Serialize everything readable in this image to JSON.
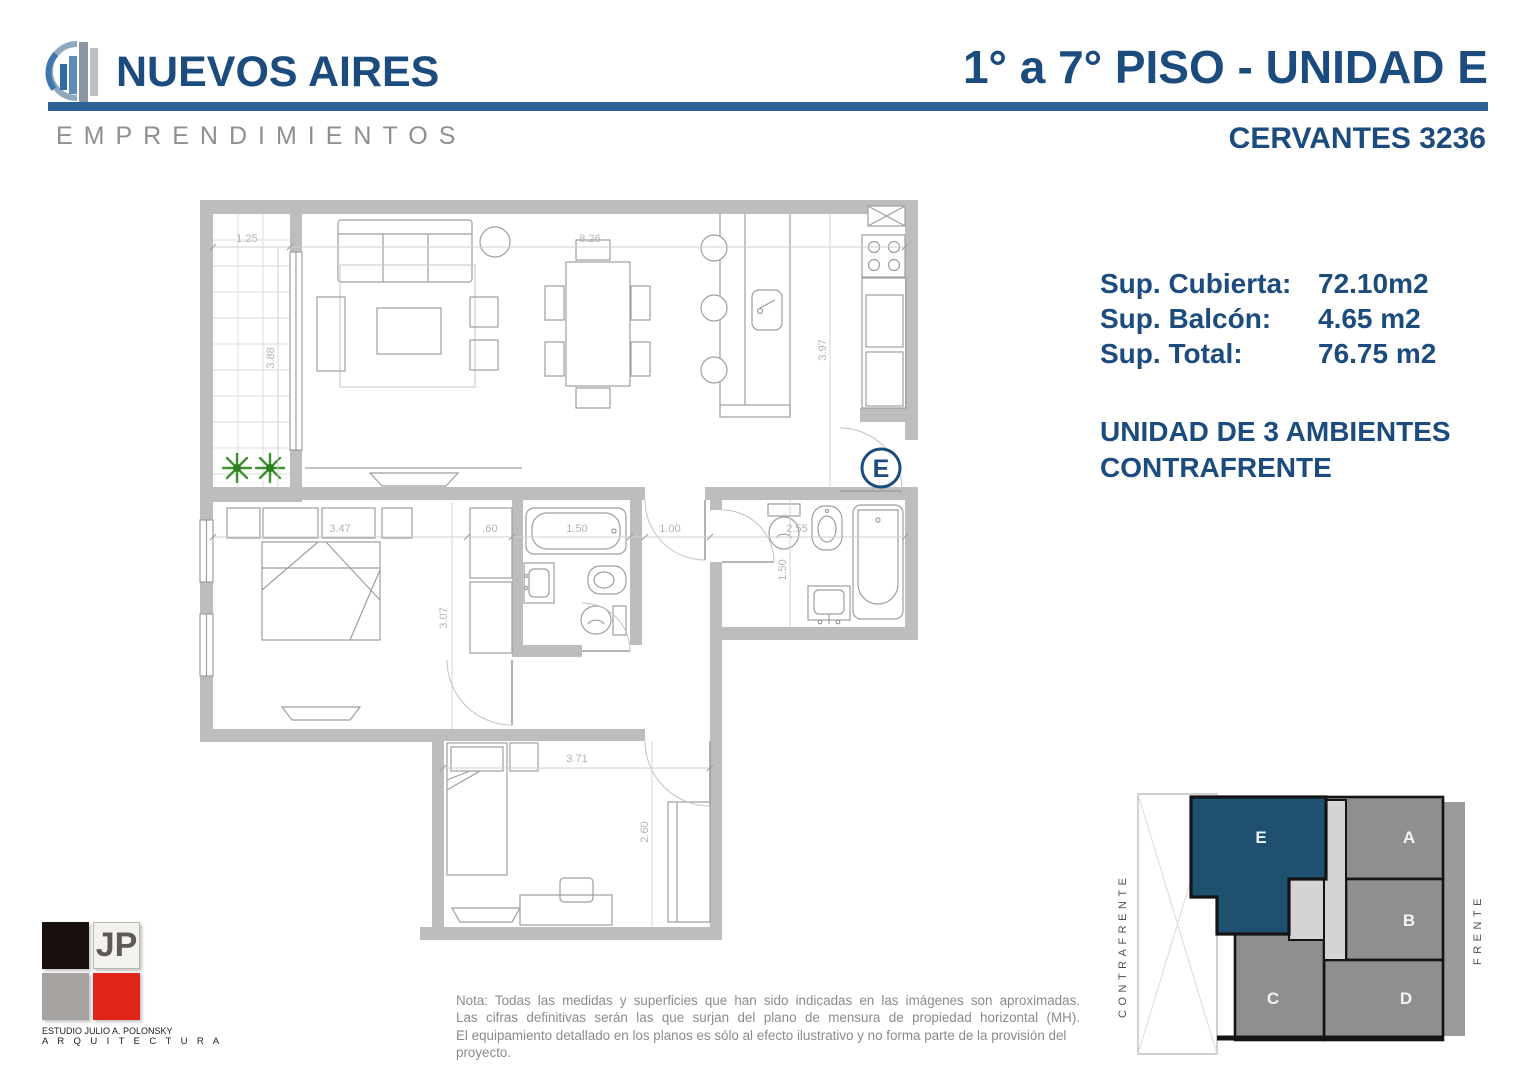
{
  "header": {
    "brand": "NUEVOS AIRES",
    "brand_sub": "EMPRENDIMIENTOS",
    "title": "1° a 7° PISO - UNIDAD E",
    "subtitle": "CERVANTES 3236",
    "accent_color": "#1c4b7e",
    "rule_color": "#2b6195"
  },
  "summary": {
    "rows": [
      {
        "label": "Sup. Cubierta:",
        "value": "72.10m2"
      },
      {
        "label": "Sup. Balcón:",
        "value": "4.65 m2"
      },
      {
        "label": "Sup. Total:",
        "value": "76.75 m2"
      }
    ],
    "unit_line1": "UNIDAD DE 3 AMBIENTES",
    "unit_line2": "CONTRAFRENTE"
  },
  "floorplan": {
    "badge": "E",
    "wall_color": "#bdbdbd",
    "dims": {
      "balcony_w": "1.25",
      "living_w": "8.26",
      "balcony_h": "3.88",
      "kitchen_h": "3.97",
      "bed1_w": "3.47",
      "wardrobe_w": ".60",
      "bath1_w": "1.50",
      "hall_w": "1.00",
      "bath2_w": "2.55",
      "bath2_h": "1.50",
      "bed1_h": "3.07",
      "bed2_w": "3.71",
      "bed2_h": "2.60"
    }
  },
  "keyplan": {
    "units": [
      "E",
      "A",
      "B",
      "C",
      "D"
    ],
    "highlight_color": "#1e506f",
    "unit_gray": "#8f8f8f",
    "left_label": "CONTRAFRENTE",
    "right_label": "FRENTE"
  },
  "architect": {
    "initials": "JP",
    "line1": "ESTUDIO JULIO A. POLONSKY",
    "line2": "A R Q U I T E C T U R A"
  },
  "note": {
    "line1": "Nota: Todas las medidas y superficies que han sido indicadas en las imágenes son aproximadas.",
    "line2": "Las cifras definitivas serán las que surjan del plano de mensura de propiedad horizontal (MH).",
    "line3": "El equipamiento detallado en los planos es sólo al efecto ilustrativo y no forma parte de la provisión del proyecto."
  }
}
